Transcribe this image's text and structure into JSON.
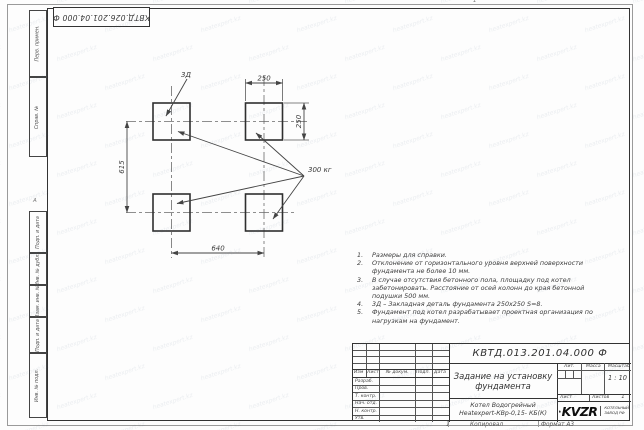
{
  "watermark": {
    "text": "heatexpert.kz"
  },
  "frame": {
    "top_stamp": "КВТД.026.201.04.000 Ф",
    "zone_left": "А",
    "zone_top": "1",
    "zone_bottom": "1",
    "margin_labels": [
      "Перв. примен.",
      "Справ. №",
      "Подп. и дата",
      "Инв. № дубл.",
      "Взам. инв. №",
      "Подп. и дата",
      "Инв. № подл."
    ]
  },
  "drawing": {
    "pad_label": "3Д",
    "load_label": "300 кг",
    "dims": {
      "top_width": "250",
      "right_height": "250",
      "left_height": "615",
      "bottom_width": "640"
    }
  },
  "notes": {
    "items": [
      {
        "num": "1.",
        "lines": [
          "Размеры для справки."
        ]
      },
      {
        "num": "2.",
        "lines": [
          "Отклонение от горизонтального уровня верхней поверхности",
          "фундамента не более 10 мм."
        ]
      },
      {
        "num": "3.",
        "lines": [
          "В случае отсутствия бетонного пола, площадку под котел",
          "забетонировать. Расстояние от осей колонн до края бетонной",
          "подушки 500 мм."
        ]
      },
      {
        "num": "4.",
        "lines": [
          "3Д – Закладная деталь фундамента 250х250 S=8."
        ]
      },
      {
        "num": "5.",
        "lines": [
          "Фундамент под котел разрабатывает проектная организация по",
          "нагрузкам на фундамент."
        ]
      }
    ]
  },
  "title_block": {
    "doc_number": "КВТД.013.201.04.000 Ф",
    "title": "Задание на установку фундамента",
    "rev_header": [
      "Изм",
      "Лист",
      "№ докум.",
      "Подп.",
      "Дата"
    ],
    "staff_rows": [
      "Разраб.",
      "Пров.",
      "Т. контр.",
      "Нач. отд.",
      "Н. контр.",
      "Утв."
    ],
    "lit_label": "Лит.",
    "mass_label": "Масса",
    "scale_label": "Масштаб",
    "scale_value": "1 : 10",
    "sheet_label": "Лист",
    "sheets_label": "Листов",
    "sheets_value": "1",
    "product_line1": "Котел Водогрейный",
    "product_line2": "Heatexpert-КВр-0,15- КБ(К)",
    "logo_text": "KVZR",
    "logo_caption_line1": "КОТЕЛЬНЫЙ",
    "logo_caption_line2": "ЗАВОД РФ",
    "copied_label": "Копировал",
    "format_label": "Формат А3"
  }
}
